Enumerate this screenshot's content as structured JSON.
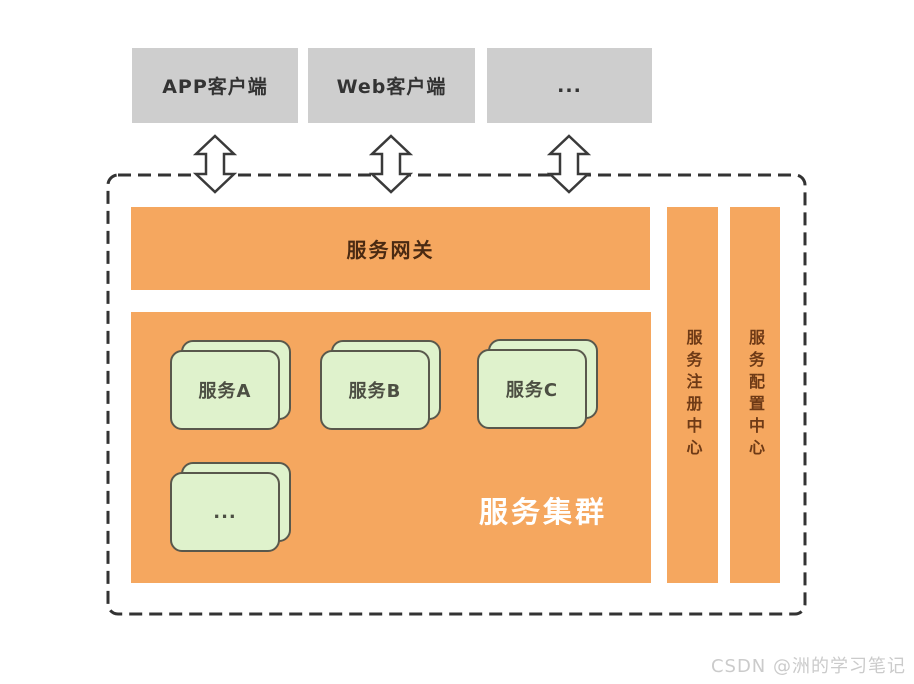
{
  "clients": [
    {
      "label": "APP客户端"
    },
    {
      "label": "Web客户端"
    },
    {
      "label": "..."
    }
  ],
  "gateway": {
    "label": "服务网关"
  },
  "cluster": {
    "label": "服务集群",
    "services": [
      {
        "label": "服务A"
      },
      {
        "label": "服务B"
      },
      {
        "label": "服务C"
      },
      {
        "label": "..."
      }
    ]
  },
  "side_centers": [
    {
      "label": "服务注册中心"
    },
    {
      "label": "服务配置中心"
    }
  ],
  "watermark": "CSDN @洲的学习笔记",
  "colors": {
    "orange": "#F5A75F",
    "client_gray": "#CECECE",
    "card_green": "#DFF2CC",
    "card_border": "#59584C",
    "dark_text": "#333333",
    "gateway_text": "#4A2A12",
    "side_text": "#6E3A16",
    "cluster_label_text": "#FFFFFF",
    "boundary_dash": "#333333",
    "arrow_outline": "#3A3A3A",
    "watermark_gray": "#CBCBCB"
  }
}
